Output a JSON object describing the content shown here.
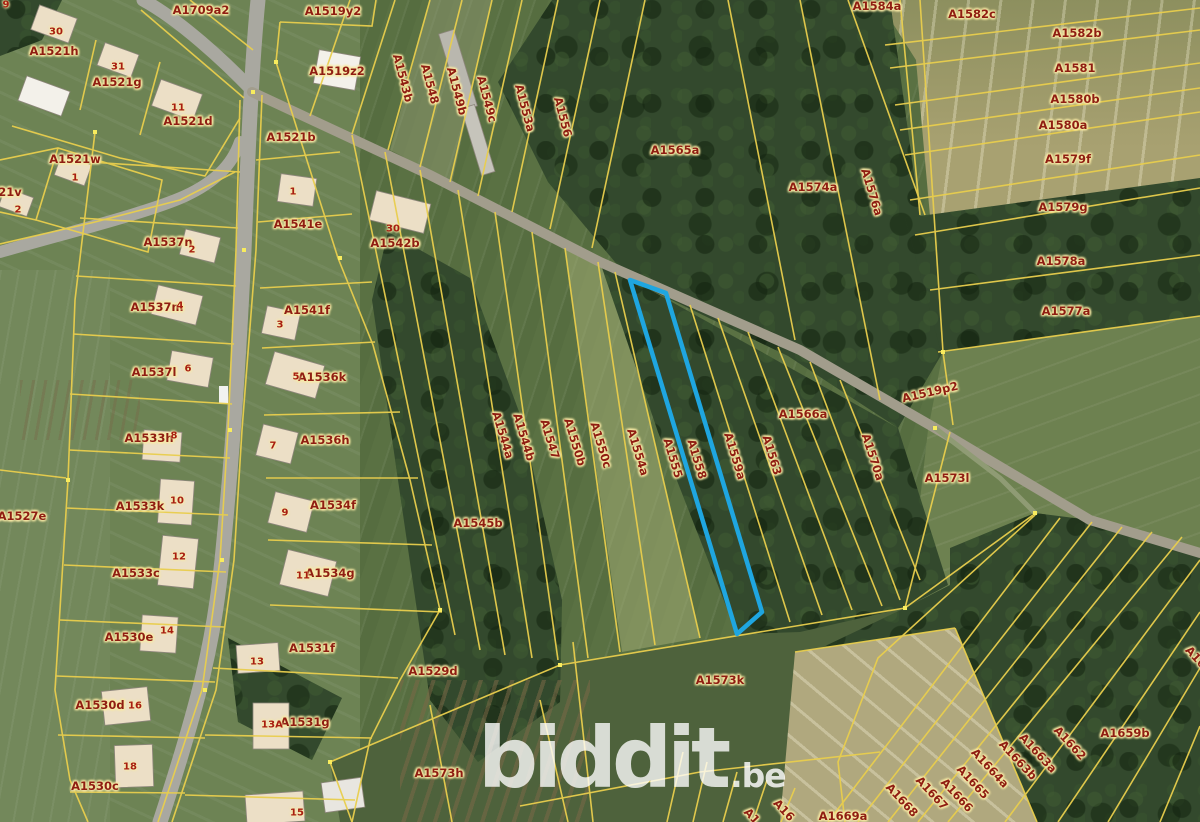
{
  "map": {
    "watermark": {
      "brand": "biddit",
      "tld": ".be"
    },
    "colors": {
      "parcel_boundary": "#e9ce4d",
      "highlight_outline": "#1fa6e0",
      "label_text": "#8f1d12",
      "label_halo": "#f8eaa6",
      "road": "#a9a8a0"
    },
    "highlighted_parcel": "A1558",
    "parcel_labels": [
      {
        "text": "A1709a2",
        "x": 201,
        "y": 10
      },
      {
        "text": "A1521h",
        "x": 54,
        "y": 51
      },
      {
        "text": "A1521g",
        "x": 117,
        "y": 82
      },
      {
        "text": "A1521d",
        "x": 188,
        "y": 121
      },
      {
        "text": "A1521w",
        "x": 75,
        "y": 159
      },
      {
        "text": "21v",
        "x": 10,
        "y": 192
      },
      {
        "text": "A1519y2",
        "x": 333,
        "y": 11
      },
      {
        "text": "A1519z2",
        "x": 337,
        "y": 71
      },
      {
        "text": "A1521b",
        "x": 291,
        "y": 137
      },
      {
        "text": "A1541e",
        "x": 298,
        "y": 224
      },
      {
        "text": "A1542b",
        "x": 395,
        "y": 243
      },
      {
        "text": "A1537n",
        "x": 168,
        "y": 242
      },
      {
        "text": "A1537m",
        "x": 157,
        "y": 307
      },
      {
        "text": "A1537l",
        "x": 154,
        "y": 372
      },
      {
        "text": "A1533h",
        "x": 149,
        "y": 438
      },
      {
        "text": "A1541f",
        "x": 307,
        "y": 310
      },
      {
        "text": "A1536k",
        "x": 322,
        "y": 377
      },
      {
        "text": "A1536h",
        "x": 325,
        "y": 440
      },
      {
        "text": "A1534f",
        "x": 333,
        "y": 505
      },
      {
        "text": "A1534g",
        "x": 330,
        "y": 573
      },
      {
        "text": "A1527e",
        "x": 22,
        "y": 516
      },
      {
        "text": "A1533k",
        "x": 140,
        "y": 506
      },
      {
        "text": "A1533c",
        "x": 136,
        "y": 573
      },
      {
        "text": "A1530e",
        "x": 129,
        "y": 637
      },
      {
        "text": "A1530d",
        "x": 100,
        "y": 705
      },
      {
        "text": "A1530c",
        "x": 95,
        "y": 786
      },
      {
        "text": "A1531f",
        "x": 312,
        "y": 648
      },
      {
        "text": "A1531g",
        "x": 305,
        "y": 722
      },
      {
        "text": "A1529d",
        "x": 433,
        "y": 671
      },
      {
        "text": "A1573h",
        "x": 439,
        "y": 773
      },
      {
        "text": "A1573k",
        "x": 720,
        "y": 680
      },
      {
        "text": "A1545b",
        "x": 478,
        "y": 523
      },
      {
        "text": "A1543b",
        "x": 403,
        "y": 78,
        "rot": 75
      },
      {
        "text": "A1548",
        "x": 430,
        "y": 84,
        "rot": 75
      },
      {
        "text": "A1549b",
        "x": 457,
        "y": 91,
        "rot": 75
      },
      {
        "text": "A1549c",
        "x": 487,
        "y": 99,
        "rot": 75
      },
      {
        "text": "A1553a",
        "x": 525,
        "y": 108,
        "rot": 75
      },
      {
        "text": "A1556",
        "x": 563,
        "y": 117,
        "rot": 75
      },
      {
        "text": "A1565a",
        "x": 675,
        "y": 150
      },
      {
        "text": "A1574a",
        "x": 813,
        "y": 187
      },
      {
        "text": "A1576a",
        "x": 872,
        "y": 192,
        "rot": 73
      },
      {
        "text": "A1584a",
        "x": 877,
        "y": 6
      },
      {
        "text": "A1582c",
        "x": 972,
        "y": 14
      },
      {
        "text": "A1582b",
        "x": 1077,
        "y": 33
      },
      {
        "text": "A1581",
        "x": 1075,
        "y": 68
      },
      {
        "text": "A1580b",
        "x": 1075,
        "y": 99
      },
      {
        "text": "A1580a",
        "x": 1063,
        "y": 125
      },
      {
        "text": "A1579f",
        "x": 1068,
        "y": 159
      },
      {
        "text": "A1579g",
        "x": 1063,
        "y": 207
      },
      {
        "text": "A1578a",
        "x": 1061,
        "y": 261
      },
      {
        "text": "A1577a",
        "x": 1066,
        "y": 311
      },
      {
        "text": "A1519p2",
        "x": 930,
        "y": 392,
        "rot": -13
      },
      {
        "text": "A1573l",
        "x": 947,
        "y": 478
      },
      {
        "text": "A1544a",
        "x": 503,
        "y": 435,
        "rot": 73
      },
      {
        "text": "A1544b",
        "x": 524,
        "y": 437,
        "rot": 73
      },
      {
        "text": "A1547",
        "x": 550,
        "y": 439,
        "rot": 73
      },
      {
        "text": "A1550b",
        "x": 575,
        "y": 442,
        "rot": 73
      },
      {
        "text": "A1550c",
        "x": 601,
        "y": 445,
        "rot": 73
      },
      {
        "text": "A1554a",
        "x": 638,
        "y": 452,
        "rot": 73
      },
      {
        "text": "A1555",
        "x": 673,
        "y": 458,
        "rot": 73
      },
      {
        "text": "A1558",
        "x": 697,
        "y": 459,
        "rot": 73
      },
      {
        "text": "A1559a",
        "x": 735,
        "y": 456,
        "rot": 73
      },
      {
        "text": "A1563",
        "x": 772,
        "y": 455,
        "rot": 73
      },
      {
        "text": "A1566a",
        "x": 803,
        "y": 414
      },
      {
        "text": "A1570a",
        "x": 873,
        "y": 457,
        "rot": 72
      },
      {
        "text": "A1669a",
        "x": 843,
        "y": 816
      },
      {
        "text": "A1668",
        "x": 902,
        "y": 800,
        "rot": 47
      },
      {
        "text": "A1667",
        "x": 932,
        "y": 793,
        "rot": 47
      },
      {
        "text": "A1666",
        "x": 957,
        "y": 795,
        "rot": 47
      },
      {
        "text": "A1665",
        "x": 973,
        "y": 782,
        "rot": 47
      },
      {
        "text": "A1664a",
        "x": 990,
        "y": 768,
        "rot": 47
      },
      {
        "text": "A1663b",
        "x": 1018,
        "y": 760,
        "rot": 47
      },
      {
        "text": "A1663a",
        "x": 1038,
        "y": 753,
        "rot": 47
      },
      {
        "text": "A1662",
        "x": 1070,
        "y": 743,
        "rot": 47
      },
      {
        "text": "A1659b",
        "x": 1125,
        "y": 733
      },
      {
        "text": "A16",
        "x": 1196,
        "y": 657,
        "rot": 47
      },
      {
        "text": "A16",
        "x": 784,
        "y": 810,
        "rot": 47
      },
      {
        "text": "A1",
        "x": 752,
        "y": 816,
        "rot": 47
      }
    ],
    "house_numbers": [
      {
        "text": "9",
        "x": 6,
        "y": 5
      },
      {
        "text": "30",
        "x": 56,
        "y": 32
      },
      {
        "text": "31",
        "x": 118,
        "y": 67
      },
      {
        "text": "11",
        "x": 178,
        "y": 108
      },
      {
        "text": "1",
        "x": 75,
        "y": 178
      },
      {
        "text": "2",
        "x": 18,
        "y": 210
      },
      {
        "text": "1",
        "x": 293,
        "y": 192
      },
      {
        "text": "30",
        "x": 393,
        "y": 229
      },
      {
        "text": "2",
        "x": 192,
        "y": 250
      },
      {
        "text": "4",
        "x": 180,
        "y": 306
      },
      {
        "text": "3",
        "x": 280,
        "y": 325
      },
      {
        "text": "6",
        "x": 188,
        "y": 369
      },
      {
        "text": "5",
        "x": 296,
        "y": 377
      },
      {
        "text": "8",
        "x": 174,
        "y": 436
      },
      {
        "text": "7",
        "x": 273,
        "y": 446
      },
      {
        "text": "10",
        "x": 177,
        "y": 501
      },
      {
        "text": "9",
        "x": 285,
        "y": 513
      },
      {
        "text": "12",
        "x": 179,
        "y": 557
      },
      {
        "text": "11",
        "x": 303,
        "y": 576
      },
      {
        "text": "14",
        "x": 167,
        "y": 631
      },
      {
        "text": "13",
        "x": 257,
        "y": 662
      },
      {
        "text": "16",
        "x": 135,
        "y": 706
      },
      {
        "text": "13A",
        "x": 272,
        "y": 725
      },
      {
        "text": "18",
        "x": 130,
        "y": 767
      },
      {
        "text": "15",
        "x": 297,
        "y": 813
      }
    ]
  }
}
